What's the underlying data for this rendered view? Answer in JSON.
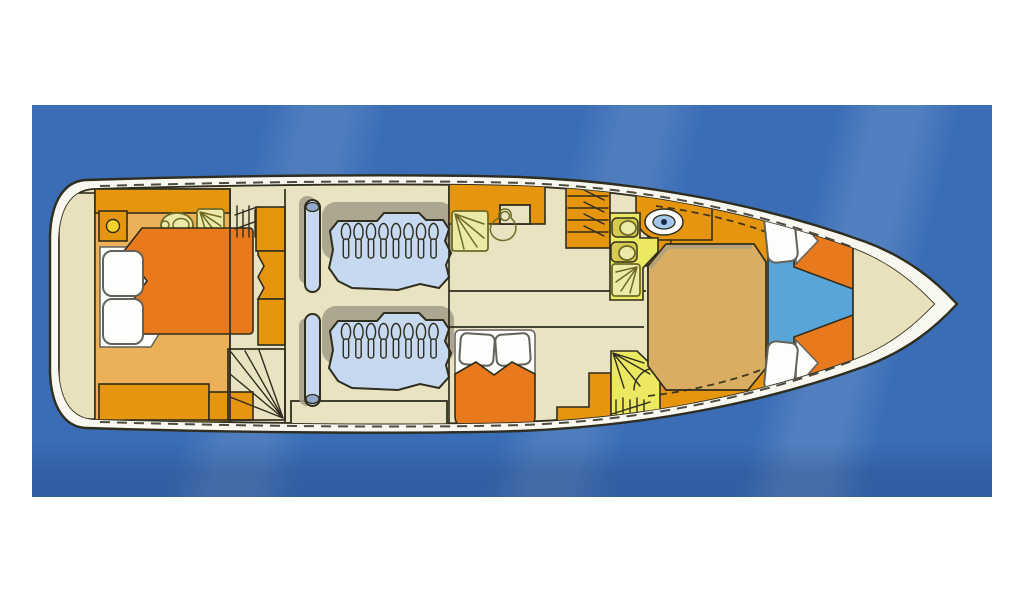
{
  "scene": {
    "type": "yacht-lower-deck-floor-plan",
    "orientation": "bow-pointing-right",
    "background": "blue-water"
  },
  "colors": {
    "page_bg": "#ffffff",
    "sea": "#3a6db6",
    "hull_rim": "#f8f7f0",
    "outline": "#2f2d1d",
    "floor_beige": "#eae3c2",
    "deck_beige": "#e8e1bc",
    "cabin_floor": "#ecb158",
    "cabinet_orange": "#e6950f",
    "bed_orange": "#e8791c",
    "dinette_tan": "#d9ae62",
    "engine_blue": "#c6d9f0",
    "engine_cap": "#93a9cc",
    "crew_floor": "#58a6d9",
    "wetroom_yellow": "#ebe862",
    "shower_pale": "#ece9a9",
    "fixture_olive": "#d6ca52",
    "olive_line": "#6f6b25",
    "sink_blue": "#a6c6e9",
    "sink_dot": "#1c2b4a",
    "porthole_yellow": "#f6d22d",
    "pillow_white": "#fdfdfb",
    "pillow_edge": "#63635c",
    "shadow_gray": "#a29b88"
  },
  "regions": [
    {
      "id": "aft-swim-platform"
    },
    {
      "id": "aft-master-cabin"
    },
    {
      "id": "companionway-corridor"
    },
    {
      "id": "engine-room"
    },
    {
      "id": "salon-galley"
    },
    {
      "id": "mid-cabin-double-berth"
    },
    {
      "id": "wet-room-forward"
    },
    {
      "id": "wet-room-aft"
    },
    {
      "id": "dinette"
    },
    {
      "id": "crew-cabin-v-berths"
    },
    {
      "id": "bow-deck"
    }
  ]
}
